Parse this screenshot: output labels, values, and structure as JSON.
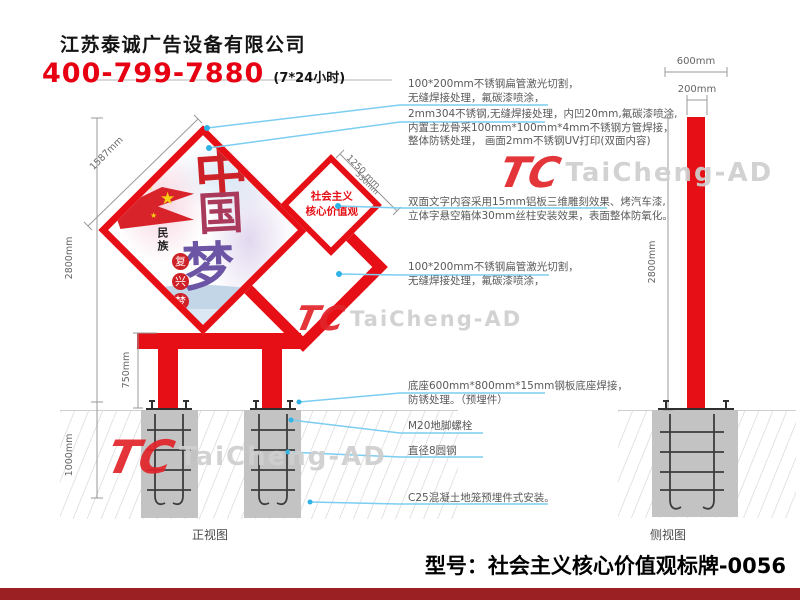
{
  "header": {
    "company": "江苏泰诚广告设备有限公司",
    "phone": "400-799-7880",
    "hours": "(7*24小时)"
  },
  "brand": {
    "mark": "TC",
    "name": "TaiCheng-AD"
  },
  "front_view": {
    "label": "正视图",
    "dims": {
      "height": "2800mm",
      "underground": "1000mm",
      "leg": "750mm",
      "panel_edge": "1587mm",
      "small_panel": "1250 mm",
      "small_panel_inner": "530mm"
    },
    "sign": {
      "line1": "社会主义",
      "line2": "核心价值观"
    },
    "artwork": {
      "char1": "中",
      "char2": "国",
      "char3": "梦",
      "subtitle": "民族",
      "badge1": "复",
      "badge2": "兴",
      "badge3": "梦",
      "star": "★"
    }
  },
  "side_view": {
    "label": "侧视图",
    "dims": {
      "base": "600mm",
      "post": "200mm",
      "height": "2800mm"
    }
  },
  "annotations": [
    {
      "lines": [
        "100*200mm不锈钢扁管激光切割，",
        "无缝焊接处理，氟碳漆喷涂，"
      ]
    },
    {
      "lines": [
        "2mm304不锈钢,无缝焊接处理，内凹20mm,氟碳漆喷涂,",
        "内置主龙骨采100mm*100mm*4mm不锈钢方管焊接，",
        "整体防锈处理， 画面2mm不锈钢UV打印(双面内容)"
      ]
    },
    {
      "lines": [
        "双面文字内容采用15mm铝板三维雕刻效果、烤汽车漆,",
        "立体字悬空箱体30mm丝柱安装效果，表面整体防氧化。"
      ]
    },
    {
      "lines": [
        "100*200mm不锈钢扁管激光切割，",
        "无缝焊接处理，氟碳漆喷涂，"
      ]
    },
    {
      "lines": [
        "底座600mm*800mm*15mm钢板底座焊接，",
        "防锈处理。（预埋件）"
      ]
    },
    {
      "lines": [
        "M20地脚螺栓"
      ]
    },
    {
      "lines": [
        "直径8圆钢"
      ]
    },
    {
      "lines": [
        "C25混凝土地笼预埋件式安装。"
      ]
    }
  ],
  "footer": {
    "model": "型号：社会主义核心价值观标牌-0056"
  },
  "colors": {
    "red": "#e50f15",
    "leader_blue": "#7bcdf1",
    "dot_cyan": "#2fb2e5",
    "footer_bar": "#9b2023",
    "footing_gray": "#c3c3c3"
  }
}
